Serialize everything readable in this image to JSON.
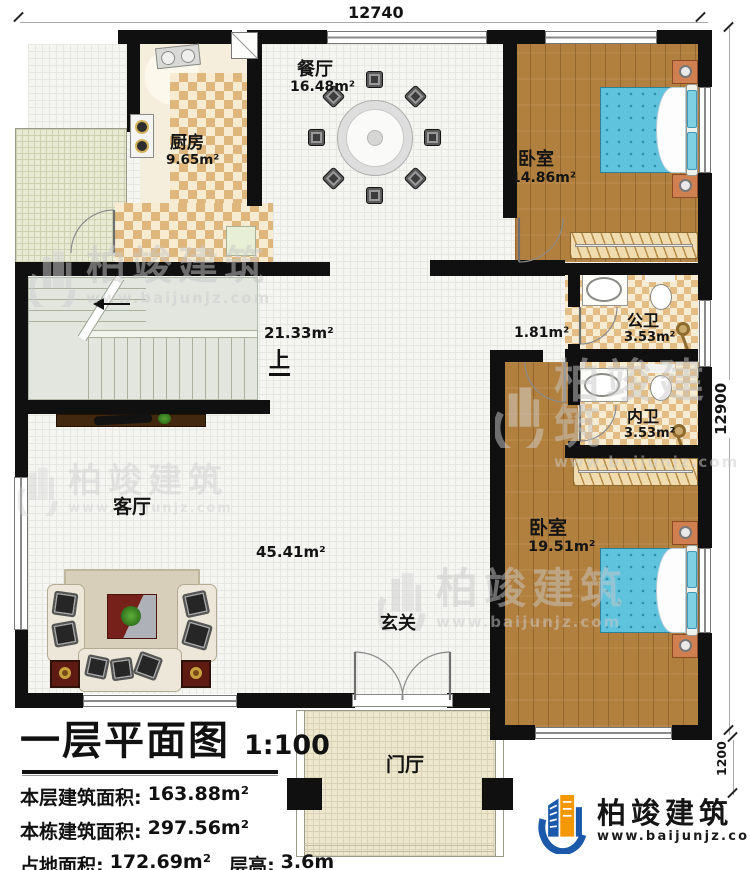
{
  "plan": {
    "dim_top": "12740",
    "dim_right": "12900",
    "dim_porch": "1200",
    "hall_area": "21.33m²",
    "corridor_area": "1.81m²",
    "stairs_up": "上",
    "foyer": "玄关",
    "porch": "门厅",
    "rooms": {
      "kitchen": {
        "name": "厨房",
        "area": "9.65m²"
      },
      "dining": {
        "name": "餐厅",
        "area": "16.48m²"
      },
      "bedroom_top": {
        "name": "卧室",
        "area": "14.86m²"
      },
      "bath_public": {
        "name": "公卫",
        "area": "3.53m²"
      },
      "bath_private": {
        "name": "内卫",
        "area": "3.53m²"
      },
      "bedroom_bottom": {
        "name": "卧室",
        "area": "19.51m²"
      },
      "living": {
        "name": "客厅",
        "area": "45.41m²"
      }
    }
  },
  "title_block": {
    "title": "一层平面图",
    "scale": "1:100",
    "row1_label": "本层建筑面积:",
    "row1_value": "163.88m²",
    "row2_label": "本栋建筑面积:",
    "row2_value": "297.56m²",
    "row3_label": "占地面积:",
    "row3_value": "172.69m²",
    "row3b_label": "层高:",
    "row3b_value": "3.6m"
  },
  "logo": {
    "name": "柏竣建筑",
    "website": "www.baijunjz.com"
  },
  "watermark": {
    "name": "柏竣建筑",
    "website": "www.baijunjz.com"
  },
  "colors": {
    "wall": "#101010",
    "wood_floor": "#b2803e",
    "tile_tan": "#dfb77c",
    "bed_blue": "#5fc3de",
    "nightstand_orange": "#d08050",
    "logo_blue": "#1c59aa",
    "logo_orange": "#f39800"
  }
}
